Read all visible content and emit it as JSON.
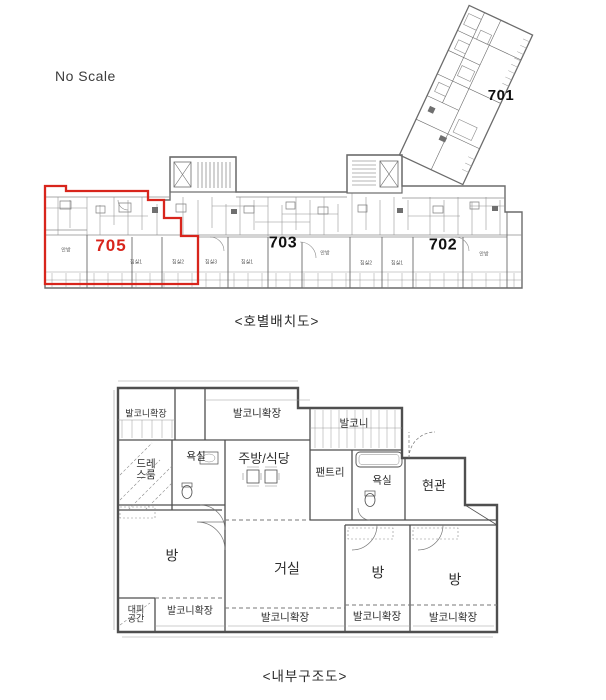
{
  "top_diagram": {
    "scale_note": "No Scale",
    "caption": "<호별배치도>",
    "units": [
      {
        "id": "705",
        "label": "705",
        "highlighted": true
      },
      {
        "id": "703",
        "label": "703",
        "highlighted": false
      },
      {
        "id": "702",
        "label": "702",
        "highlighted": false
      },
      {
        "id": "701",
        "label": "701",
        "highlighted": false
      }
    ],
    "small_labels": [
      {
        "text": "안방"
      },
      {
        "text": "침실1"
      },
      {
        "text": "침실2"
      },
      {
        "text": "침실3"
      },
      {
        "text": "침실1"
      },
      {
        "text": "안방"
      },
      {
        "text": "침실2"
      },
      {
        "text": "침실1"
      },
      {
        "text": "안방"
      }
    ]
  },
  "bottom_diagram": {
    "caption": "<내부구조도>",
    "rooms": [
      {
        "label": "발코니확장"
      },
      {
        "label": "발코니확장"
      },
      {
        "label": "발코니"
      },
      {
        "label": "드레스룸"
      },
      {
        "label": "욕실"
      },
      {
        "label": "주방/식당"
      },
      {
        "label": "팬트리"
      },
      {
        "label": "욕실"
      },
      {
        "label": "현관"
      },
      {
        "label": "방"
      },
      {
        "label": "거실"
      },
      {
        "label": "방"
      },
      {
        "label": "방"
      },
      {
        "label": "대피공간"
      },
      {
        "label": "발코니확장"
      },
      {
        "label": "발코니확장"
      },
      {
        "label": "발코니확장"
      },
      {
        "label": "발코니확장"
      }
    ]
  },
  "colors": {
    "highlight_red": "#d8251c",
    "line_gray": "#6b6b6b",
    "wall_dark": "#4f4f4f",
    "text_dark": "#2e2e2e"
  }
}
